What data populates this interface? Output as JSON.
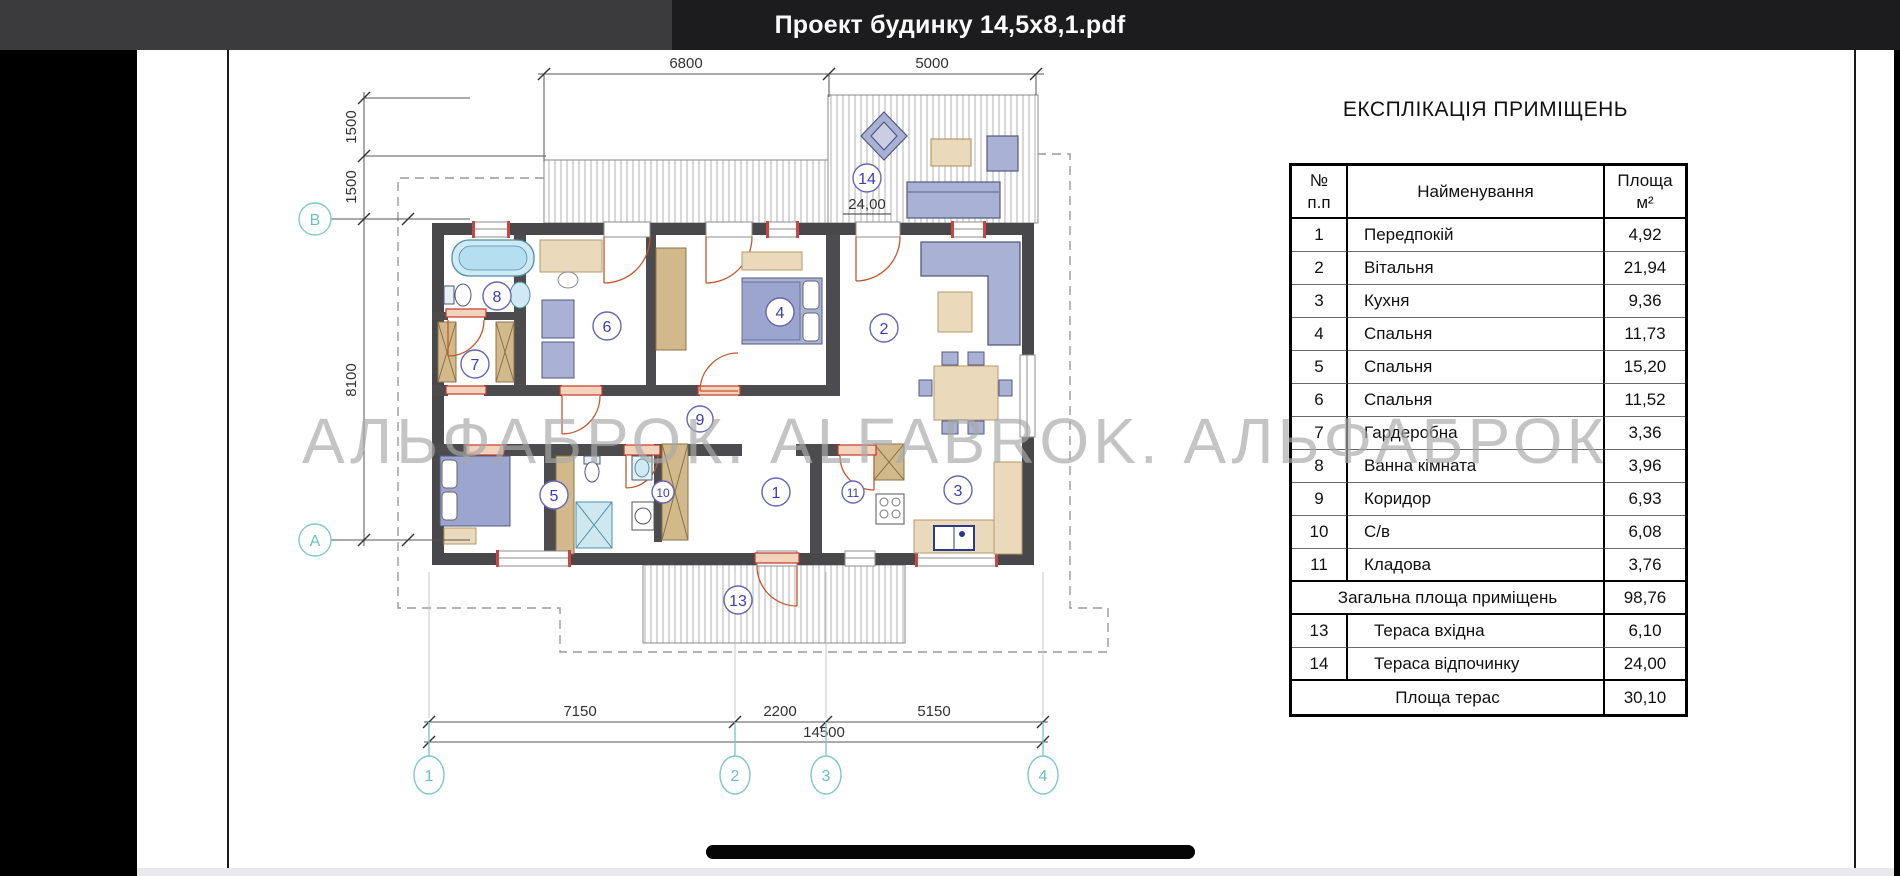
{
  "app": {
    "titlebar": {
      "filename": "Проект будинку 14,5х8,1.pdf"
    }
  },
  "watermark": "АЛЬФАБРОК. ALFABROK. АЛЬФАБРОК",
  "plan": {
    "dims": {
      "top1": "6800",
      "top2": "5000",
      "left1": "1500",
      "left2": "1500",
      "left3": "8100",
      "b1": "7150",
      "b2": "2200",
      "b3": "5150",
      "btotal": "14500",
      "terrace14_area": "24,00"
    },
    "grid": {
      "c1": "1",
      "c2": "2",
      "c3": "3",
      "c4": "4",
      "rB": "В",
      "rA": "А"
    },
    "rooms": {
      "r1": "1",
      "r2": "2",
      "r3": "3",
      "r4": "4",
      "r5": "5",
      "r6": "6",
      "r7": "7",
      "r8": "8",
      "r9": "9",
      "r10": "10",
      "r11": "11",
      "r13": "13",
      "r14": "14"
    }
  },
  "table": {
    "title": "ЕКСПЛІКАЦІЯ ПРИМІЩЕНЬ",
    "header": {
      "num1": "№",
      "num2": "п.п",
      "name": "Найменування",
      "area1": "Площа",
      "area2": "м²"
    },
    "rows": [
      {
        "num": "1",
        "name": "Передпокій",
        "area": "4,92"
      },
      {
        "num": "2",
        "name": "Вітальня",
        "area": "21,94"
      },
      {
        "num": "3",
        "name": "Кухня",
        "area": "9,36"
      },
      {
        "num": "4",
        "name": "Спальня",
        "area": "11,73"
      },
      {
        "num": "5",
        "name": "Спальня",
        "area": "15,20"
      },
      {
        "num": "6",
        "name": "Спальня",
        "area": "11,52"
      },
      {
        "num": "7",
        "name": "Гардеробна",
        "area": "3,36"
      },
      {
        "num": "8",
        "name": "Ванна кімната",
        "area": "3,96"
      },
      {
        "num": "9",
        "name": "Коридор",
        "area": "6,93"
      },
      {
        "num": "10",
        "name": "С/в",
        "area": "6,08"
      },
      {
        "num": "11",
        "name": "Кладова",
        "area": "3,76"
      }
    ],
    "total_rooms": {
      "label": "Загальна площа приміщень",
      "value": "98,76"
    },
    "terrace_rows": [
      {
        "num": "13",
        "name": "Тераса вхідна",
        "area": "6,10"
      },
      {
        "num": "14",
        "name": "Тераса відпочинку",
        "area": "24,00"
      }
    ],
    "total_terrace": {
      "label": "Площа терас",
      "value": "30,10"
    }
  }
}
